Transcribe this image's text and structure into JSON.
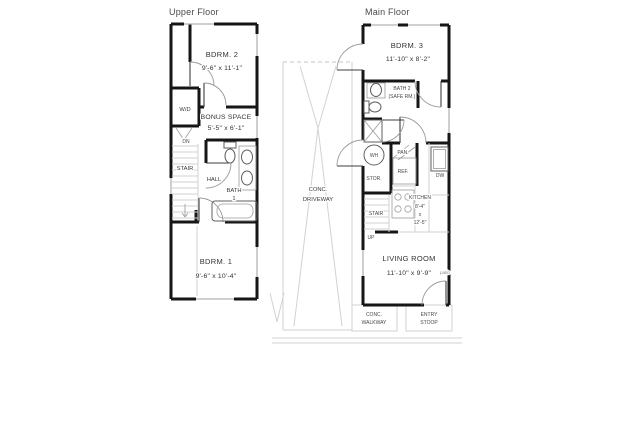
{
  "upper_floor": {
    "title": "Upper Floor",
    "bdrm2_name": "BDRM. 2",
    "bdrm2_dims": "9'-6\" x 11'-1\"",
    "wd_label": "W/D",
    "bonus_name": "BONUS SPACE",
    "bonus_dims": "5'-5\" x 6'-1\"",
    "dn_label": "DN",
    "stair_label": "STAIR",
    "hall_label": "HALL",
    "bath1_line1": "BATH",
    "bath1_line2": "1",
    "bdrm1_name": "BDRM. 1",
    "bdrm1_dims": "9'-6\" x 10'-4\""
  },
  "site": {
    "driveway_line1": "CONC.",
    "driveway_line2": "DRIVEWAY",
    "walkway_line1": "CONC.",
    "walkway_line2": "WALKWAY",
    "stoop_line1": "ENTRY",
    "stoop_line2": "STOOP"
  },
  "main_floor": {
    "title": "Main Floor",
    "bdrm3_name": "BDRM. 3",
    "bdrm3_dims": "11'-10\" x 8'-2\"",
    "bath2_line1": "BATH 2",
    "bath2_line2": "(SAFE RM.)",
    "wh_label": "WH",
    "pan_label": "PAN.",
    "ref_label": "REF.",
    "stor_label": "STOR.",
    "dw_label": "DW",
    "stair_label": "STAIR",
    "up_label": "UP",
    "kitchen_line1": "KITCHEN",
    "kitchen_line2": "8'-4\"",
    "kitchen_line3": "x",
    "kitchen_line4": "12'-5\"",
    "living_name": "LIVING ROOM",
    "living_dims": "11'-10\" x 9'-9\"",
    "patio_label": "patio"
  }
}
